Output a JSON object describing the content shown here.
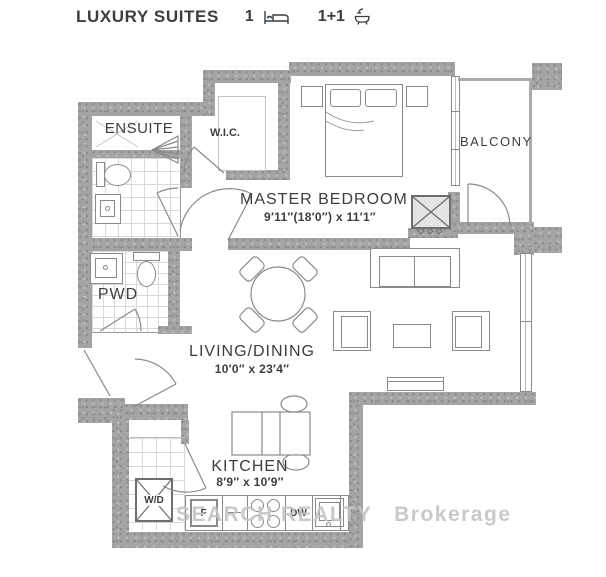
{
  "header": {
    "title": "LUXURY SUITES",
    "bed_count": "1",
    "bath_count": "1+1"
  },
  "rooms": {
    "ensuite": {
      "label": "ENSUITE"
    },
    "wic": {
      "label": "W.I.C."
    },
    "master_bedroom": {
      "label": "MASTER BEDROOM",
      "dimensions": "9′11″(18′0″) x 11′1″"
    },
    "balcony": {
      "label": "BALCONY"
    },
    "pwd": {
      "label": "PWD"
    },
    "living_dining": {
      "label": "LIVING/DINING",
      "dimensions": "10′0″ x 23′4″"
    },
    "kitchen": {
      "label": "KITCHEN",
      "dimensions": "8′9″ x 10′9″"
    }
  },
  "appliances": {
    "washer_dryer": "W/D",
    "fridge": "F",
    "dishwasher": "DW"
  },
  "watermark": {
    "part1": "SEARCH REALTY",
    "part2": "Brokerage"
  },
  "colors": {
    "wall": "#a4a4a4",
    "line": "#8a8a8a",
    "text": "#3a3e41",
    "watermark": "#c3c3c3"
  }
}
